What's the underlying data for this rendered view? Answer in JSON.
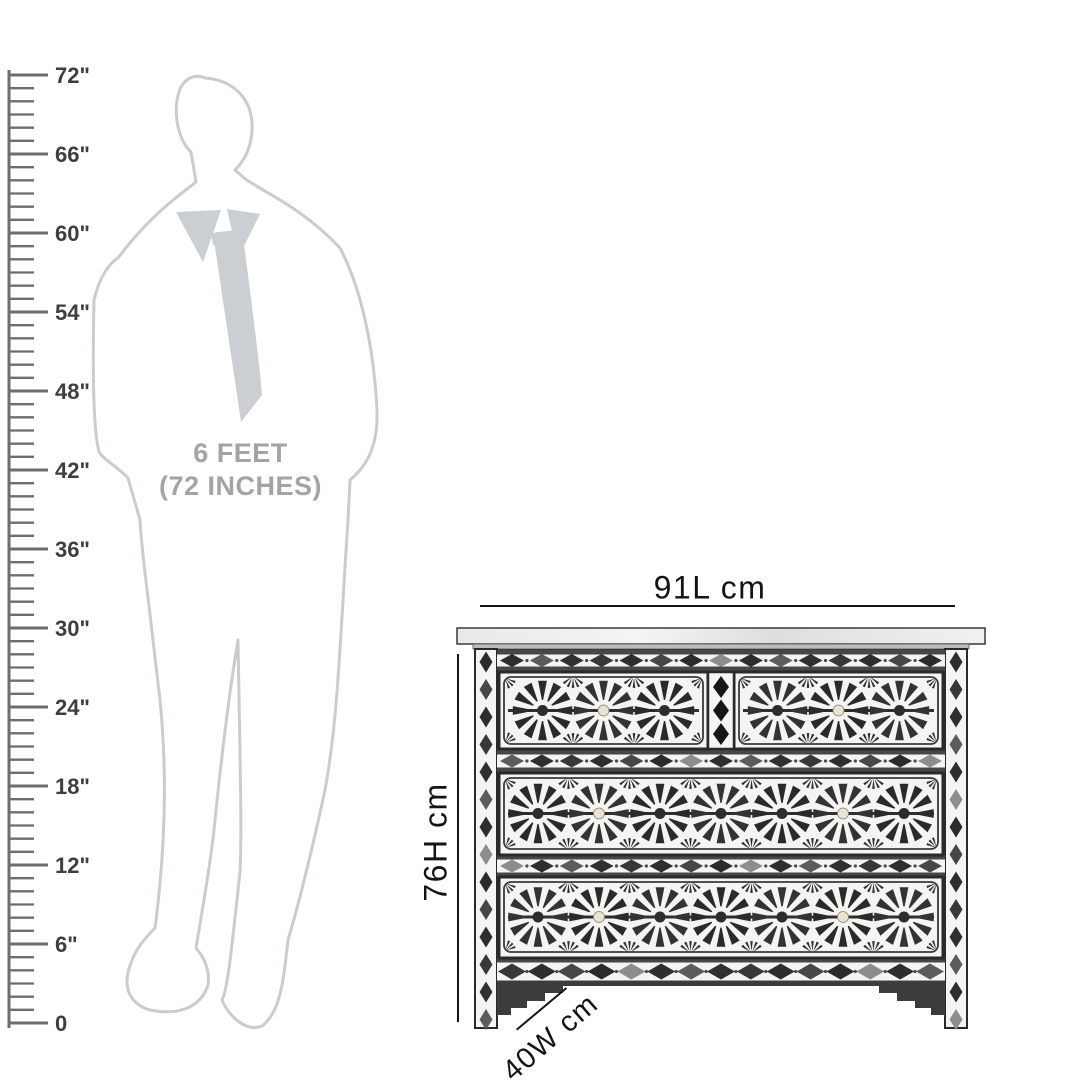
{
  "scene": {
    "background": "#ffffff"
  },
  "ruler": {
    "labels": [
      "72\"",
      "66\"",
      "60\"",
      "54\"",
      "48\"",
      "42\"",
      "36\"",
      "30\"",
      "24\"",
      "18\"",
      "12\"",
      "6\"",
      "0"
    ],
    "line_color": "#6e6e6e",
    "label_color": "#3e3e3e"
  },
  "figure": {
    "caption_line1": "6 FEET",
    "caption_line2": "(72 INCHES)",
    "caption_color": "#a2a4a6",
    "outline_color": "#c9cdd0",
    "accent_fill": "#cbcfd2"
  },
  "product": {
    "dimensions": {
      "length": "91L cm",
      "height": "76H cm",
      "width": "40W cm"
    },
    "palette": {
      "dark": "#2e2e2e",
      "frame": "#2a2a2a",
      "panel": "#f4f4f2",
      "bone": "#e9e3d1",
      "rail": "#474747",
      "slab": "#ededeb"
    }
  }
}
